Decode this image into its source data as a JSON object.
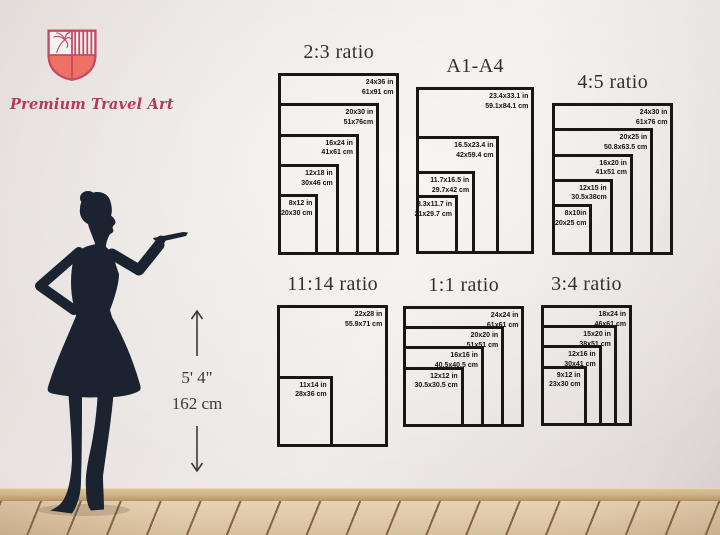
{
  "brand": {
    "name": "Premium Travel Art"
  },
  "model": {
    "height_ft": "5' 4\"",
    "height_cm": "162 cm"
  },
  "colors": {
    "accent_rose": "#c44b63",
    "accent_coral": "#ed7165",
    "brand_text": "#b23a5c",
    "silhouette": "#1b2330",
    "chart_border": "#181715"
  },
  "icons": {
    "shield": "shield-icon",
    "palm_tree": "palm-tree-icon",
    "arrow_up": "arrow-up-icon",
    "arrow_down": "arrow-down-icon"
  },
  "charts": [
    {
      "id": "2-3",
      "title": "2:3 ratio",
      "sizes": [
        {
          "in": "24x36 in",
          "cm": "61x91 cm",
          "w": 24,
          "h": 36
        },
        {
          "in": "20x30 in",
          "cm": "51x76cm",
          "w": 20,
          "h": 30
        },
        {
          "in": "16x24 in",
          "cm": "41x61 cm",
          "w": 16,
          "h": 24
        },
        {
          "in": "12x18 in",
          "cm": "30x46 cm",
          "w": 12,
          "h": 18
        },
        {
          "in": "8x12 in",
          "cm": "20x30 cm",
          "w": 8,
          "h": 12
        }
      ]
    },
    {
      "id": "a1-a4",
      "title": "A1-A4",
      "sizes": [
        {
          "in": "23.4x33.1 in",
          "cm": "59.1x84.1 cm",
          "w": 23.4,
          "h": 33.1
        },
        {
          "in": "16.5x23.4 in",
          "cm": "42x59.4 cm",
          "w": 16.5,
          "h": 23.4
        },
        {
          "in": "11.7x16.5 in",
          "cm": "29.7x42 cm",
          "w": 11.7,
          "h": 16.5
        },
        {
          "in": "8.3x11.7 in",
          "cm": "21x29.7 cm",
          "w": 8.3,
          "h": 11.7
        }
      ]
    },
    {
      "id": "4-5",
      "title": "4:5 ratio",
      "sizes": [
        {
          "in": "24x30 in",
          "cm": "61x76 cm",
          "w": 24,
          "h": 30
        },
        {
          "in": "20x25 in",
          "cm": "50.8x63.5 cm",
          "w": 20,
          "h": 25
        },
        {
          "in": "16x20 in",
          "cm": "41x51 cm",
          "w": 16,
          "h": 20
        },
        {
          "in": "12x15 in",
          "cm": "30.5x38cm",
          "w": 12,
          "h": 15
        },
        {
          "in": "8x10in",
          "cm": "20x25 cm",
          "w": 8,
          "h": 10
        }
      ]
    },
    {
      "id": "11-14",
      "title": "11:14 ratio",
      "sizes": [
        {
          "in": "22x28 in",
          "cm": "55.9x71 cm",
          "w": 22,
          "h": 28
        },
        {
          "in": "11x14 in",
          "cm": "28x36 cm",
          "w": 11,
          "h": 14
        }
      ]
    },
    {
      "id": "1-1",
      "title": "1:1 ratio",
      "sizes": [
        {
          "in": "24x24 in",
          "cm": "61x61 cm",
          "w": 24,
          "h": 24
        },
        {
          "in": "20x20 in",
          "cm": "51x51 cm",
          "w": 20,
          "h": 20
        },
        {
          "in": "16x16 in",
          "cm": "40.5x40.5 cm",
          "w": 16,
          "h": 16
        },
        {
          "in": "12x12 in",
          "cm": "30.5x30.5 cm",
          "w": 12,
          "h": 12
        }
      ]
    },
    {
      "id": "3-4",
      "title": "3:4 ratio",
      "sizes": [
        {
          "in": "18x24 in",
          "cm": "46x61 cm",
          "w": 18,
          "h": 24
        },
        {
          "in": "15x20 in",
          "cm": "38x51 cm",
          "w": 15,
          "h": 20
        },
        {
          "in": "12x16 in",
          "cm": "30x41 cm",
          "w": 12,
          "h": 16
        },
        {
          "in": "9x12 in",
          "cm": "23x30 cm",
          "w": 9,
          "h": 12
        }
      ]
    }
  ]
}
